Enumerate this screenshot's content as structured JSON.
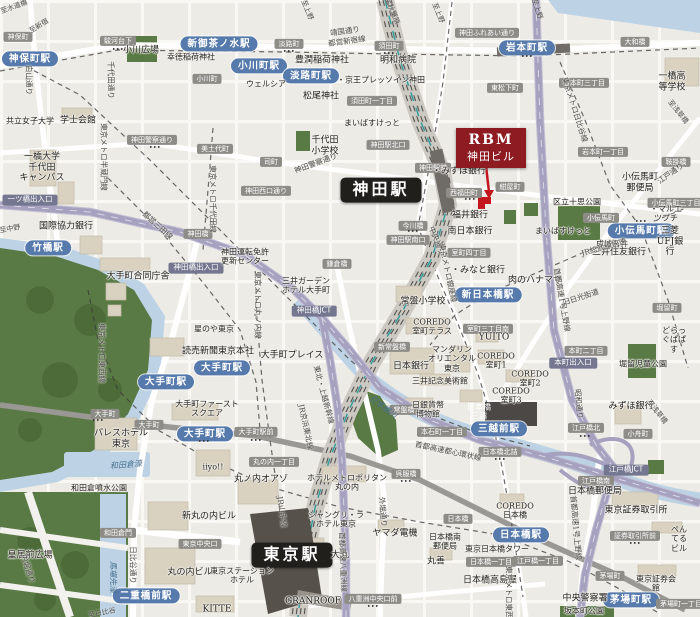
{
  "target": {
    "line1": "RBM",
    "line2": "神田ビル"
  },
  "colors": {
    "target_badge": "#8e1b22",
    "station_badge": "#567aab",
    "major_station_badge": "#211f1c",
    "road_badge": "#8e8c87",
    "highway_badge": "#74778f",
    "highway": "#a5a1bf",
    "water": "#bdd3e5",
    "park": "#5a7a45",
    "rail_corridor": "#ccc9c3"
  },
  "labels": [
    {
      "n": "station-badge-jimbocho",
      "t": "神保町駅",
      "x": 30,
      "y": 59,
      "c": "st"
    },
    {
      "n": "station-badge-shin-ochanomizu",
      "t": "新御茶ノ水駅",
      "x": 219,
      "y": 44,
      "c": "st"
    },
    {
      "n": "station-badge-ogawamachi",
      "t": "小川町駅",
      "x": 259,
      "y": 66,
      "c": "st"
    },
    {
      "n": "station-badge-awajicho",
      "t": "淡路町駅",
      "x": 311,
      "y": 76,
      "c": "st"
    },
    {
      "n": "station-badge-iwamotocho",
      "t": "岩本町駅",
      "x": 527,
      "y": 48,
      "c": "st"
    },
    {
      "n": "station-badge-takebashi",
      "t": "竹橋駅",
      "x": 48,
      "y": 248,
      "c": "st"
    },
    {
      "n": "station-badge-otemachi-1",
      "t": "大手町駅",
      "x": 222,
      "y": 368,
      "c": "st"
    },
    {
      "n": "station-badge-otemachi-2",
      "t": "大手町駅",
      "x": 166,
      "y": 382,
      "c": "st"
    },
    {
      "n": "station-badge-otemachi-3",
      "t": "大手町駅",
      "x": 205,
      "y": 434,
      "c": "st"
    },
    {
      "n": "station-badge-kodemmacho",
      "t": "小伝馬町駅",
      "x": 641,
      "y": 231,
      "c": "st"
    },
    {
      "n": "station-badge-shin-nihombashi",
      "t": "新日本橋駅",
      "x": 488,
      "y": 295,
      "c": "st"
    },
    {
      "n": "station-badge-mitsukoshimae",
      "t": "三越前駅",
      "x": 499,
      "y": 429,
      "c": "st"
    },
    {
      "n": "station-badge-nijubashimae",
      "t": "二重橋前駅",
      "x": 146,
      "y": 596,
      "c": "st"
    },
    {
      "n": "station-badge-nihombashi",
      "t": "日本橋駅",
      "x": 521,
      "y": 535,
      "c": "st"
    },
    {
      "n": "station-badge-kayabacho",
      "t": "茅場町駅",
      "x": 631,
      "y": 600,
      "c": "st"
    },
    {
      "n": "station-badge-kanda",
      "t": "神田駅",
      "x": 381,
      "y": 190,
      "c": "stlg"
    },
    {
      "n": "station-badge-tokyo",
      "t": "東京駅",
      "x": 292,
      "y": 555,
      "c": "stlg"
    },
    {
      "t": "神保町",
      "x": 18,
      "y": 37,
      "c": "rd"
    },
    {
      "t": "駿河台下",
      "x": 118,
      "y": 41,
      "c": "rd"
    },
    {
      "t": "小川町",
      "x": 207,
      "y": 79,
      "c": "rd"
    },
    {
      "t": "淡路町",
      "x": 289,
      "y": 44,
      "c": "rd"
    },
    {
      "t": "須田町",
      "x": 389,
      "y": 46,
      "c": "rd"
    },
    {
      "t": "須田町一丁目",
      "x": 372,
      "y": 101,
      "c": "rd"
    },
    {
      "t": "神田ふれあい通り",
      "x": 487,
      "y": 33,
      "c": "rd"
    },
    {
      "t": "岩本町三丁目",
      "x": 584,
      "y": 83,
      "c": "rd"
    },
    {
      "t": "東松下町",
      "x": 505,
      "y": 88,
      "c": "rd"
    },
    {
      "t": "大和橋",
      "x": 635,
      "y": 42,
      "c": "rd"
    },
    {
      "t": "美土代町",
      "x": 215,
      "y": 149,
      "c": "rd"
    },
    {
      "t": "神田警察通り",
      "x": 152,
      "y": 140,
      "c": "rd"
    },
    {
      "t": "司町",
      "x": 271,
      "y": 162,
      "c": "rd"
    },
    {
      "t": "神田西口通り",
      "x": 266,
      "y": 191,
      "c": "rd"
    },
    {
      "t": "神田駅北口",
      "x": 388,
      "y": 145,
      "c": "rd"
    },
    {
      "t": "神田駅前",
      "x": 433,
      "y": 168,
      "c": "rd"
    },
    {
      "t": "神田駅南口",
      "x": 408,
      "y": 240,
      "c": "rd"
    },
    {
      "t": "今川橋",
      "x": 413,
      "y": 226,
      "c": "rd"
    },
    {
      "t": "紺屋町",
      "x": 510,
      "y": 187,
      "c": "rd"
    },
    {
      "t": "西福田町",
      "x": 464,
      "y": 193,
      "c": "rd"
    },
    {
      "t": "岩本町一丁目",
      "x": 603,
      "y": 152,
      "c": "rd"
    },
    {
      "t": "鞍掛橋",
      "x": 676,
      "y": 162,
      "c": "rd"
    },
    {
      "t": "小伝馬町",
      "x": 601,
      "y": 218,
      "c": "rd"
    },
    {
      "t": "小伝馬町三丁目",
      "x": 676,
      "y": 203,
      "c": "rd"
    },
    {
      "t": "室町四丁目",
      "x": 469,
      "y": 253,
      "c": "rd"
    },
    {
      "t": "堀留町",
      "x": 667,
      "y": 308,
      "c": "rd"
    },
    {
      "t": "室町三丁目南",
      "x": 488,
      "y": 329,
      "c": "rd"
    },
    {
      "t": "本町二丁目",
      "x": 586,
      "y": 351,
      "c": "rd"
    },
    {
      "t": "新常盤橋",
      "x": 392,
      "y": 347,
      "c": "rd"
    },
    {
      "t": "鎌倉橋",
      "x": 337,
      "y": 264,
      "c": "rd"
    },
    {
      "t": "神田橋",
      "x": 198,
      "y": 234,
      "c": "rd"
    },
    {
      "t": "常盤橋",
      "x": 404,
      "y": 410,
      "c": "rd"
    },
    {
      "t": "本石町一丁目",
      "x": 442,
      "y": 432,
      "c": "rd"
    },
    {
      "t": "大手町駅前",
      "x": 256,
      "y": 432,
      "c": "rd"
    },
    {
      "t": "丸の内一丁目",
      "x": 274,
      "y": 462,
      "c": "rd"
    },
    {
      "t": "呉服橋",
      "x": 406,
      "y": 474,
      "c": "rd"
    },
    {
      "t": "大手町",
      "x": 105,
      "y": 414,
      "c": "rd"
    },
    {
      "t": "大手町",
      "x": 149,
      "y": 425,
      "c": "rd"
    },
    {
      "t": "和田倉門",
      "x": 118,
      "y": 533,
      "c": "rd"
    },
    {
      "t": "東京中央口",
      "x": 200,
      "y": 544,
      "c": "rd"
    },
    {
      "t": "八重洲中央口前",
      "x": 373,
      "y": 599,
      "c": "rd"
    },
    {
      "t": "日本橋",
      "x": 458,
      "y": 519,
      "c": "rd"
    },
    {
      "t": "江戸橋北",
      "x": 586,
      "y": 428,
      "c": "rd"
    },
    {
      "t": "小舟町",
      "x": 638,
      "y": 434,
      "c": "rd"
    },
    {
      "t": "日本橋北詰",
      "x": 500,
      "y": 452,
      "c": "rd"
    },
    {
      "t": "江戸橋南",
      "x": 596,
      "y": 481,
      "c": "rd"
    },
    {
      "t": "江戸橋一丁目",
      "x": 538,
      "y": 561,
      "c": "rd"
    },
    {
      "t": "日本橋一丁目",
      "x": 491,
      "y": 562,
      "c": "rd"
    },
    {
      "t": "証券取引所前",
      "x": 635,
      "y": 536,
      "c": "rd"
    },
    {
      "t": "茅場町",
      "x": 610,
      "y": 576,
      "c": "rd"
    },
    {
      "t": "茅場町一丁目",
      "x": 681,
      "y": 604,
      "c": "rd"
    },
    {
      "t": "一ツ橋出入口",
      "x": 30,
      "y": 200,
      "c": "hw"
    },
    {
      "t": "神田橋出入口",
      "x": 196,
      "y": 268,
      "c": "hw"
    },
    {
      "t": "神田橋JCT",
      "x": 314,
      "y": 311,
      "c": "hw"
    },
    {
      "t": "本町出入口",
      "x": 573,
      "y": 363,
      "c": "hw"
    },
    {
      "t": "江戸橋JCT",
      "x": 626,
      "y": 470,
      "c": "hw"
    },
    {
      "t": "小川広場",
      "x": 141,
      "y": 51,
      "c": "pl"
    },
    {
      "t": "幸徳稲荷神社",
      "x": 191,
      "y": 57,
      "c": "pls"
    },
    {
      "t": "豊潤稲荷神社",
      "x": 322,
      "y": 61,
      "c": "pl"
    },
    {
      "t": "松尾神社",
      "x": 321,
      "y": 97,
      "c": "pl"
    },
    {
      "t": "ウェルシア",
      "x": 266,
      "y": 84,
      "c": "pls"
    },
    {
      "t": "・京王プレッソイン神田",
      "x": 381,
      "y": 80,
      "c": "pls"
    },
    {
      "t": "明和病院",
      "x": 398,
      "y": 61,
      "c": "pl"
    },
    {
      "t": "一橋高等学校",
      "x": 672,
      "y": 82,
      "c": "pl"
    },
    {
      "t": "共立女子大学",
      "x": 30,
      "y": 121,
      "c": "pls"
    },
    {
      "t": "学士会館",
      "x": 78,
      "y": 121,
      "c": "pl"
    },
    {
      "t": "一橋大学\n千代田\nキャンパス",
      "x": 42,
      "y": 168,
      "c": "pl"
    },
    {
      "t": "千代田\n小学校",
      "x": 325,
      "y": 146,
      "c": "pl"
    },
    {
      "t": "神田運転免許\n更新センター",
      "x": 245,
      "y": 257,
      "c": "pls"
    },
    {
      "t": "国際協力銀行",
      "x": 66,
      "y": 227,
      "c": "pl"
    },
    {
      "t": "大手町合同庁舎",
      "x": 138,
      "y": 277,
      "c": "pl"
    },
    {
      "t": "星のや東京",
      "x": 214,
      "y": 329,
      "c": "pls"
    },
    {
      "t": "読売新聞東京本社",
      "x": 218,
      "y": 352,
      "c": "pl"
    },
    {
      "t": "大手町プレイス",
      "x": 292,
      "y": 356,
      "c": "pl"
    },
    {
      "t": "三井ガーデン\nホテル大手町",
      "x": 306,
      "y": 286,
      "c": "pls"
    },
    {
      "t": "常盤小学校",
      "x": 423,
      "y": 302,
      "c": "pl"
    },
    {
      "t": "COREDO\n室町テラス",
      "x": 432,
      "y": 327,
      "c": "pls"
    },
    {
      "t": "マンダリン\nオリエンタル\n東京",
      "x": 452,
      "y": 359,
      "c": "pls"
    },
    {
      "t": "日本銀行",
      "x": 411,
      "y": 367,
      "c": "pl"
    },
    {
      "t": "三井記念美術館",
      "x": 440,
      "y": 381,
      "c": "pls"
    },
    {
      "t": "日銀貨幣\n博物館",
      "x": 428,
      "y": 410,
      "c": "pls"
    },
    {
      "t": "・みずほ銀行",
      "x": 459,
      "y": 172,
      "c": "pl"
    },
    {
      "t": "福井銀行",
      "x": 470,
      "y": 216,
      "c": "pl"
    },
    {
      "t": "南日本銀行",
      "x": 470,
      "y": 232,
      "c": "pl"
    },
    {
      "t": "・みなと銀行",
      "x": 478,
      "y": 271,
      "c": "pl"
    },
    {
      "t": "まいばすけっと",
      "x": 372,
      "y": 123,
      "c": "pls"
    },
    {
      "t": "まいばすけっと",
      "x": 563,
      "y": 231,
      "c": "pls"
    },
    {
      "t": "小伝馬町\n郵便局",
      "x": 640,
      "y": 183,
      "c": "pl"
    },
    {
      "t": "区立十思公園",
      "x": 577,
      "y": 202,
      "c": "pls"
    },
    {
      "t": "・マルエツプチ",
      "x": 666,
      "y": 214,
      "c": "pls"
    },
    {
      "t": "成城石井",
      "x": 612,
      "y": 244,
      "c": "pls"
    },
    {
      "t": "三菱UFJ銀行",
      "x": 670,
      "y": 242,
      "c": "pl"
    },
    {
      "t": "三井住友銀行",
      "x": 619,
      "y": 253,
      "c": "pl"
    },
    {
      "t": "肉のハナマサ",
      "x": 535,
      "y": 281,
      "c": "pl"
    },
    {
      "t": "どらっぐぱぱす",
      "x": 674,
      "y": 340,
      "c": "pls"
    },
    {
      "t": "堀留児童公園",
      "x": 643,
      "y": 364,
      "c": "pls"
    },
    {
      "t": "YUITO",
      "x": 494,
      "y": 338,
      "c": "pl"
    },
    {
      "t": "COREDO\n室町1",
      "x": 496,
      "y": 361,
      "c": "pls"
    },
    {
      "t": "COREDO\n室町2",
      "x": 530,
      "y": 379,
      "c": "pls"
    },
    {
      "t": "COREDO\n室町3",
      "x": 511,
      "y": 396,
      "c": "pls"
    },
    {
      "t": "日本橋\n三越",
      "x": 479,
      "y": 412,
      "c": "wtx"
    },
    {
      "t": "みずほ銀行",
      "x": 631,
      "y": 407,
      "c": "pl"
    },
    {
      "t": "日本橋郵便局",
      "x": 595,
      "y": 492,
      "c": "pl"
    },
    {
      "t": "COREDO\n日本橋",
      "x": 515,
      "y": 511,
      "c": "pls"
    },
    {
      "t": "東京日本橋タワー",
      "x": 497,
      "y": 549,
      "c": "pls"
    },
    {
      "t": "日本橋高島屋",
      "x": 490,
      "y": 581,
      "c": "pl"
    },
    {
      "t": "中央警察署",
      "x": 585,
      "y": 599,
      "c": "pl"
    },
    {
      "t": "坂本町公園",
      "x": 584,
      "y": 611,
      "c": "pls"
    },
    {
      "t": "東京証券取引所",
      "x": 636,
      "y": 511,
      "c": "pl"
    },
    {
      "t": "ぺんてるビル",
      "x": 679,
      "y": 539,
      "c": "pls"
    },
    {
      "t": "東京証券会館",
      "x": 656,
      "y": 584,
      "c": "pls"
    },
    {
      "t": "ヤマダ電機",
      "x": 395,
      "y": 534,
      "c": "pl"
    },
    {
      "t": "日本橋南\n郵便局",
      "x": 445,
      "y": 542,
      "c": "pls"
    },
    {
      "t": "丸善",
      "x": 436,
      "y": 562,
      "c": "pl"
    },
    {
      "t": "シャングリ・ラ\nホテル東京",
      "x": 336,
      "y": 520,
      "c": "pls"
    },
    {
      "t": "大丸",
      "x": 340,
      "y": 556,
      "c": "pl"
    },
    {
      "t": "東京ステーション\nホテル",
      "x": 242,
      "y": 576,
      "c": "pls"
    },
    {
      "t": "GRANROOF",
      "x": 313,
      "y": 602,
      "c": "pl"
    },
    {
      "t": "新丸の内ビル",
      "x": 209,
      "y": 517,
      "c": "pl"
    },
    {
      "t": "丸の内ビル",
      "x": 190,
      "y": 573,
      "c": "pl"
    },
    {
      "t": "KITTE",
      "x": 217,
      "y": 610,
      "c": "pl"
    },
    {
      "t": "丸ノ内オアゾ",
      "x": 261,
      "y": 480,
      "c": "pl"
    },
    {
      "t": "ホテルメトロポリタン\n丸の内",
      "x": 347,
      "y": 483,
      "c": "pls"
    },
    {
      "t": "パレスホテル\n東京",
      "x": 121,
      "y": 439,
      "c": "pl"
    },
    {
      "t": "大手町ファースト\nスクエア",
      "x": 207,
      "y": 409,
      "c": "pls"
    },
    {
      "t": "iiyo!!",
      "x": 213,
      "y": 467,
      "c": "pls"
    },
    {
      "t": "和田倉噴水公園",
      "x": 99,
      "y": 488,
      "c": "pls"
    },
    {
      "t": "皇居前広場",
      "x": 30,
      "y": 556,
      "c": "pl"
    },
    {
      "t": "和田倉濠",
      "x": 126,
      "y": 465,
      "c": "wt",
      "r": -5
    },
    {
      "t": "馬場先濠",
      "x": 113,
      "y": 577,
      "c": "wt",
      "r": 90
    },
    {
      "t": "日本橋川",
      "x": 383,
      "y": 407,
      "c": "wt",
      "r": 38
    },
    {
      "t": "白山通り",
      "x": 28,
      "y": 80,
      "c": "rl",
      "r": 90
    },
    {
      "t": "千代田通り",
      "x": 110,
      "y": 80,
      "c": "rl",
      "r": 90
    },
    {
      "t": "靖国通り",
      "x": 345,
      "y": 32,
      "c": "rl",
      "r": -8
    },
    {
      "t": "都営新宿線",
      "x": 347,
      "y": 42,
      "c": "rl",
      "r": -8
    },
    {
      "t": "東京メトロ半蔵門線",
      "x": 103,
      "y": 157,
      "c": "rl",
      "r": 90
    },
    {
      "t": "東京メトロ千代田線",
      "x": 212,
      "y": 199,
      "c": "rl",
      "r": 90
    },
    {
      "t": "都営三田線",
      "x": 157,
      "y": 226,
      "c": "rl",
      "r": 42
    },
    {
      "t": "神田警察通り",
      "x": 316,
      "y": 164,
      "c": "rl",
      "r": -20
    },
    {
      "t": "東京メトロ丸ノ内線",
      "x": 257,
      "y": 305,
      "c": "rl",
      "r": 90
    },
    {
      "t": "東京メトロ東西線",
      "x": 101,
      "y": 353,
      "c": "rl",
      "r": 90
    },
    {
      "t": "中央通り",
      "x": 436,
      "y": 241,
      "c": "rl",
      "r": 68
    },
    {
      "t": "東京メトロ銀座線",
      "x": 447,
      "y": 273,
      "c": "rl",
      "r": 78
    },
    {
      "t": "東京メトロ日比谷線",
      "x": 574,
      "y": 110,
      "c": "rl",
      "r": 72
    },
    {
      "t": "JR総武線快速",
      "x": 604,
      "y": 248,
      "c": "rl",
      "r": -16
    },
    {
      "t": "旧日光街道",
      "x": 581,
      "y": 298,
      "c": "rl",
      "r": -18
    },
    {
      "t": "昭和通り",
      "x": 578,
      "y": 404,
      "c": "rl",
      "r": 85
    },
    {
      "t": "江戸通り",
      "x": 671,
      "y": 174,
      "c": "rl",
      "r": -35
    },
    {
      "t": "日比谷通り",
      "x": 132,
      "y": 565,
      "c": "rl",
      "r": 90
    },
    {
      "t": "内堀通り",
      "x": 27,
      "y": 569,
      "c": "rl",
      "r": 72
    },
    {
      "t": "外堀通り",
      "x": 382,
      "y": 512,
      "c": "rl",
      "r": 85
    },
    {
      "t": "首都高速八重洲線",
      "x": 342,
      "y": 562,
      "c": "rl",
      "r": 88
    },
    {
      "t": "首都高速1号上野線",
      "x": 561,
      "y": 300,
      "c": "rl",
      "r": 80
    },
    {
      "t": "首都高速1号上野線",
      "x": 575,
      "y": 528,
      "c": "rl",
      "r": 85
    },
    {
      "t": "首都高速都心環状線",
      "x": 448,
      "y": 452,
      "c": "rl",
      "r": 12
    },
    {
      "t": "東北・上越新幹線",
      "x": 323,
      "y": 395,
      "c": "rl",
      "r": 75
    },
    {
      "t": "JR京浜東北線",
      "x": 305,
      "y": 427,
      "c": "rl",
      "r": 78
    },
    {
      "t": "JR山手線",
      "x": 281,
      "y": 512,
      "c": "rl",
      "r": 82
    },
    {
      "t": "東京メトロ東西線",
      "x": 508,
      "y": 596,
      "c": "rl",
      "r": 90
    },
    {
      "t": "至水道橋",
      "x": 14,
      "y": 7,
      "c": "dir",
      "r": -20
    },
    {
      "t": "至新宿",
      "x": 39,
      "y": 26,
      "c": "dir",
      "r": -32
    },
    {
      "t": "至中野",
      "x": 10,
      "y": 229,
      "c": "dir",
      "r": -10
    },
    {
      "t": "至上野",
      "x": 307,
      "y": 10,
      "c": "dir",
      "r": 68
    },
    {
      "t": "至秋葉原",
      "x": 392,
      "y": 11,
      "c": "dir",
      "r": 68
    },
    {
      "t": "至上野",
      "x": 438,
      "y": 13,
      "c": "dir",
      "r": 68
    },
    {
      "t": "至上野",
      "x": 537,
      "y": 9,
      "c": "dir",
      "r": 72
    },
    {
      "t": "至浅草橋",
      "x": 678,
      "y": 112,
      "c": "dir",
      "r": 52
    },
    {
      "t": "至浅草橋",
      "x": 657,
      "y": 412,
      "c": "dir",
      "r": 52
    },
    {
      "t": "至日比谷",
      "x": 102,
      "y": 613,
      "c": "dir",
      "r": -12
    },
    {
      "t": "•••",
      "x": 118,
      "y": 50,
      "c": "dots"
    },
    {
      "t": "•••",
      "x": 289,
      "y": 52,
      "c": "dots"
    },
    {
      "t": "•••",
      "x": 389,
      "y": 54,
      "c": "dots"
    },
    {
      "t": "•••",
      "x": 527,
      "y": 57,
      "c": "dots"
    },
    {
      "t": "•••",
      "x": 155,
      "y": 148,
      "c": "dots"
    },
    {
      "t": "•••",
      "x": 413,
      "y": 232,
      "c": "dots"
    },
    {
      "t": "•••",
      "x": 256,
      "y": 441,
      "c": "dots"
    },
    {
      "t": "•••",
      "x": 406,
      "y": 482,
      "c": "dots"
    },
    {
      "t": "•••",
      "x": 470,
      "y": 200,
      "c": "dots"
    },
    {
      "t": "•••",
      "x": 641,
      "y": 222,
      "c": "dots"
    },
    {
      "t": "•••",
      "x": 373,
      "y": 607,
      "c": "dots"
    },
    {
      "t": "•••",
      "x": 585,
      "y": 437,
      "c": "dots"
    },
    {
      "t": "•••",
      "x": 635,
      "y": 544,
      "c": "dots"
    },
    {
      "t": "•••",
      "x": 204,
      "y": 442,
      "c": "dots"
    },
    {
      "t": "•••",
      "x": 98,
      "y": 421,
      "c": "dots"
    },
    {
      "t": "•••",
      "x": 500,
      "y": 460,
      "c": "dots"
    }
  ]
}
